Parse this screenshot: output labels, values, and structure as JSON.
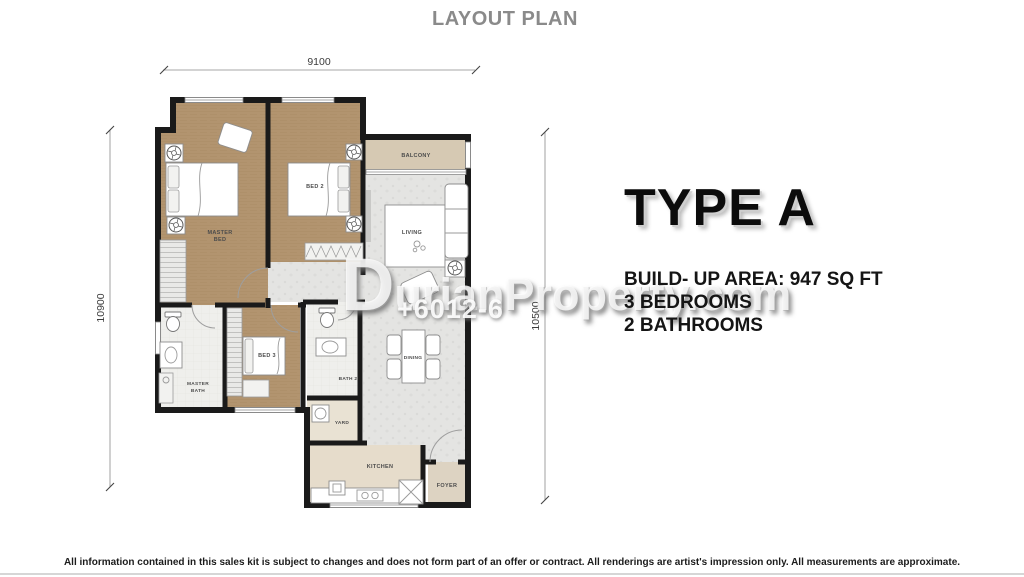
{
  "page": {
    "title": "LAYOUT PLAN",
    "footer": "All information contained in this sales kit is subject to changes and does not form part of an offer or contract. All renderings are artist's impression only. All measurements are approximate."
  },
  "watermark": {
    "site_initial": "D",
    "site_rest": "urianProperty.com",
    "phone": "+6012-6"
  },
  "unit": {
    "type": "TYPE A",
    "area": "BUILD- UP AREA: 947 SQ FT",
    "bedrooms": "3 BEDROOMS",
    "bathrooms": "2 BATHROOMS"
  },
  "plan": {
    "dim_top": "9100",
    "dim_left": "10900",
    "dim_right": "10500",
    "rooms": {
      "master_bed_1": "MASTER",
      "master_bed_2": "BED",
      "bed2": "BED 2",
      "bed3": "BED 3",
      "balcony": "BALCONY",
      "living": "LIVING",
      "dining": "DINING",
      "kitchen": "KITCHEN",
      "foyer": "FOYER",
      "master_bath_1": "MASTER",
      "master_bath_2": "BATH",
      "bath2": "BATH 2",
      "yard": "YARD"
    },
    "colors": {
      "wall": "#1a1a1a",
      "wood_floor": "#b2946f",
      "balcony_floor": "#d6c9b3",
      "tile_floor": "#e4e4e2",
      "kitchen_floor": "#e6dccb",
      "foyer_floor": "#ddd3c2",
      "yard_floor": "#e9e2d3",
      "title_gray": "#8a8a8a"
    }
  }
}
